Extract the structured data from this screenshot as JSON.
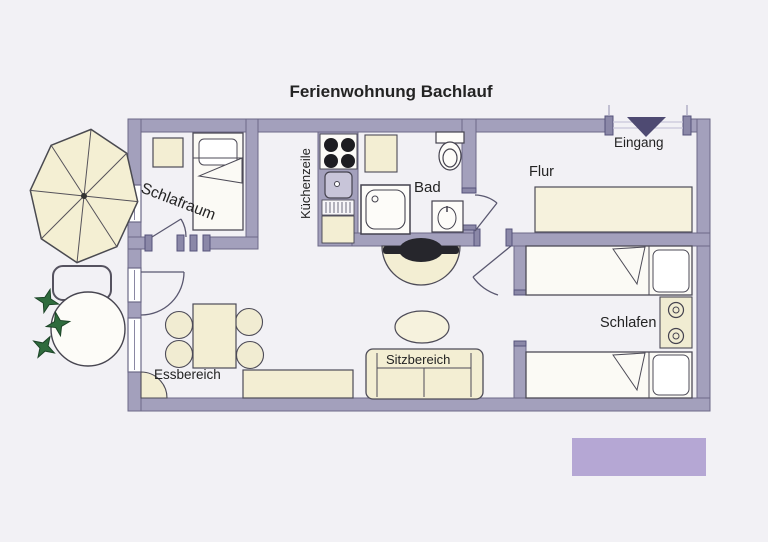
{
  "title": "Ferienwohnung Bachlauf",
  "labels": {
    "schlafraum": "Schlafraum",
    "kuechenzeile": "Küchenzeile",
    "bad": "Bad",
    "flur": "Flur",
    "eingang": "Eingang",
    "schlafen": "Schlafen",
    "sitzbereich": "Sitzbereich",
    "essbereich": "Essbereich"
  },
  "colors": {
    "wall": "#a3a0bc",
    "wall_edge": "#6c6987",
    "furniture_cream": "#f3eed3",
    "bed_white": "#fbfaf5",
    "entrance_marker": "#4e4a72",
    "plant_green": "#2f6b3d",
    "accent_purple": "#b5a7d4",
    "background": "#f2f1f5"
  }
}
